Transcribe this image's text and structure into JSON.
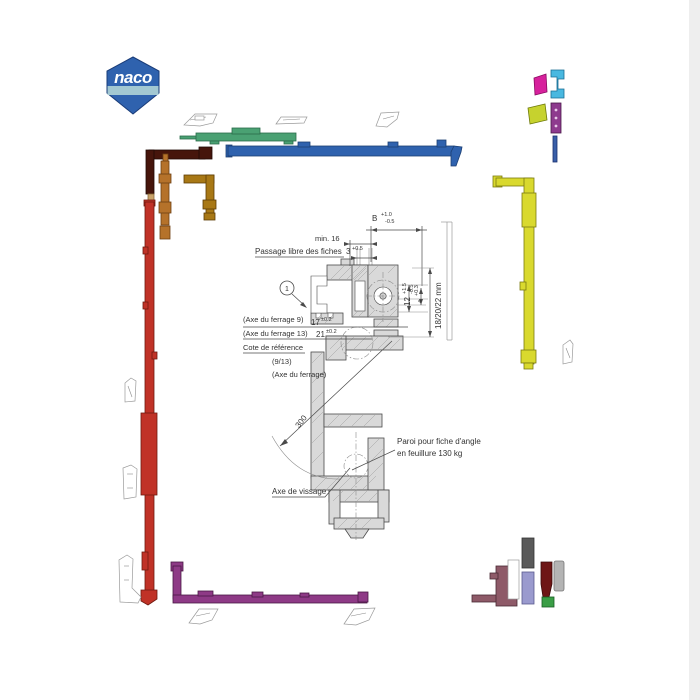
{
  "page": {
    "edge_color": "#eeeeee"
  },
  "logo": {
    "text": "naco",
    "body_color": "#2f62ae",
    "band_color": "#a3c8d2"
  },
  "drawing": {
    "balloon_number": "1",
    "dim_b": {
      "value": "B",
      "tol_plus": "+1.0",
      "tol_minus": "-0.5"
    },
    "dim_min": "min. 16",
    "passage_label": "Passage libre des fiches",
    "dim_gap": {
      "value": "3",
      "tol": "+0.5"
    },
    "axe9_label": "(Axe du ferrage 9)",
    "dim_17": {
      "value": "17",
      "tol": "±0.2"
    },
    "axe13_label": "(Axe du ferrage 13)",
    "dim_21": {
      "value": "21",
      "tol": "±0.2"
    },
    "cote_label": "Cote de référence",
    "ratio_label": "(9/13)",
    "axe_label": "(Axe du ferrage)",
    "dim_12": {
      "value": "12",
      "tol_plus": "+1.5",
      "tol_minus": "-0.5"
    },
    "dim_4": {
      "value": "4",
      "tol": "+0.3"
    },
    "dim_depth": "18/20/22 mm",
    "dim_radius": "300",
    "paroi_label_line1": "Paroi pour fiche d'angle",
    "paroi_label_line2": "en feuillure 130 kg",
    "vissage_label": "Axe de vissage"
  },
  "parts": {
    "blue_top_bar": "#2f62ae",
    "green_latch": "#4aa173",
    "dark_red_corner": "#46150b",
    "tan_tail": "#c9a36a",
    "orange_strip": "#b5722a",
    "gold_corner": "#a87815",
    "red_espagnolette": "#c03227",
    "yellow_espagnolette": "#d9d92e",
    "purple_bottom_bar": "#8e3a86",
    "mauve_bracket": "#8e5a68",
    "pink_cap": "#d6219c",
    "cyan_handle": "#49b8e0",
    "chartreuse_wedge": "#c6d22e",
    "purple_keeper": "#8e3a8e",
    "blue_rod": "#3a5fa8",
    "gray_strip": "#5a5a5a",
    "lavender_strip": "#9a9ace",
    "dark_red_keeper": "#6e1616",
    "silver_cylinder": "#b4b4b4",
    "green_clip": "#3a9e46"
  }
}
